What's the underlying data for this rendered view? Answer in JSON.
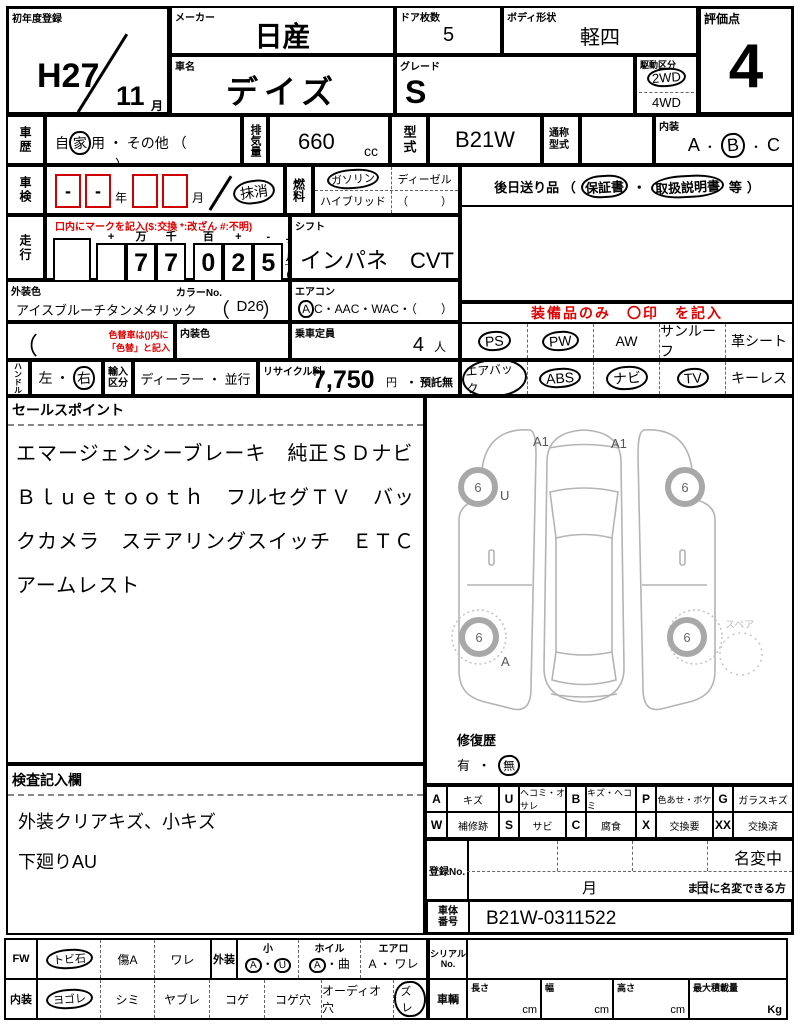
{
  "header": {
    "first_reg_label": "初年度登録",
    "first_reg_year": "H27",
    "first_reg_month": "11",
    "month_unit": "月",
    "maker_label": "メーカー",
    "maker": "日産",
    "car_name_label": "車名",
    "car_name": "デイズ",
    "doors_label": "ドア枚数",
    "doors": "5",
    "body_label": "ボディ形状",
    "body": "軽四",
    "grade_label": "グレード",
    "grade": "S",
    "drive_label": "駆動区分",
    "drive_2wd": "2WD",
    "drive_4wd": "4WD",
    "score_label": "評価点",
    "score": "4"
  },
  "history": {
    "label": "車歴",
    "p1": "自",
    "c": "家",
    "p2": "用",
    "sep": "・",
    "p3": "その他 （",
    "p4": "）"
  },
  "displacement": {
    "label": "排気量",
    "value": "660",
    "unit": "cc"
  },
  "model": {
    "label": "型式",
    "value": "B21W"
  },
  "common_model": {
    "label": "通称型式"
  },
  "interior": {
    "label": "内装",
    "a": "A",
    "b": "B",
    "c": "C",
    "dot": "・"
  },
  "shaken": {
    "label": "車検",
    "d1": "-",
    "d2": "-",
    "year": "年",
    "month": "月",
    "cancel": "抹消"
  },
  "fuel": {
    "label": "燃料",
    "gasoline": "ガソリン",
    "diesel": "ディーゼル",
    "hybrid": "ハイブリッド",
    "paren": "（　　　）"
  },
  "okuri": {
    "pre": "後日送り品 （",
    "w1": "保証書",
    "dot": "・",
    "w2": "取扱説明書",
    "tou": "等",
    "close": "）"
  },
  "mileage": {
    "label": "走行",
    "note": "口内にマークを記入($:交換 *:改ざん #:不明)",
    "cols": [
      "+",
      "万",
      "千",
      "百",
      "+",
      "-"
    ],
    "d": [
      "",
      "7",
      "7",
      "0",
      "2",
      "5"
    ],
    "comma": ",",
    "mile": "マイル",
    "km": "Km"
  },
  "shift": {
    "label": "シフト",
    "value": "インパネ　CVT"
  },
  "ext_color": {
    "label": "外装色",
    "value": "アイスブルーチタンメタリック",
    "color_no_label": "カラーNo.",
    "open": "（",
    "no": "D26",
    "close": "）"
  },
  "aircon": {
    "label": "エアコン",
    "a": "A",
    "rest": "C・AAC・WAC・（　　）"
  },
  "irogae": {
    "paren": "（　　　　）",
    "note1": "色替車は()内に",
    "note2": "「色替」と記入"
  },
  "int_color": {
    "label": "内装色"
  },
  "capacity": {
    "label": "乗車定員",
    "value": "4",
    "unit": "人"
  },
  "equip": {
    "note": "装備品のみ　〇印　を記入",
    "row1": [
      "PS",
      "PW",
      "AW",
      "サンルーフ",
      "革シート"
    ],
    "row2": [
      "エアバック",
      "ABS",
      "ナビ",
      "TV",
      "キーレス"
    ]
  },
  "handle": {
    "label": "ハンドル",
    "left": "左",
    "dot": "・",
    "right": "右"
  },
  "import": {
    "label1": "輸入",
    "label2": "区分",
    "value": "ディーラー ・ 並行"
  },
  "recycle": {
    "label": "リサイクル料",
    "fee": "7,750",
    "yen": "円",
    "rest": "・ 預託無"
  },
  "sales": {
    "label": "セールスポイント",
    "text": "エマージェンシーブレーキ　純正ＳＤナビ　Ｂｌｕｅｔｏｏｔｈ　フルセグＴＶ　バックカメラ　ステアリングスイッチ　ＥＴＣ　アームレスト"
  },
  "inspection": {
    "label": "検査記入欄",
    "line1": "外装クリアキズ、小キズ",
    "line2": "下廻りAU"
  },
  "diagram": {
    "a1": "A1",
    "u": "U",
    "a": "A",
    "tire": "6",
    "spare": "スペア",
    "repair_label": "修復歴",
    "repair_yes": "有",
    "repair_dot": "・",
    "repair_no": "無"
  },
  "legend": {
    "r1": [
      {
        "k": "A",
        "v": "キズ"
      },
      {
        "k": "U",
        "v": "ヘコミ・オサレ"
      },
      {
        "k": "B",
        "v": "キズ・ヘコミ"
      },
      {
        "k": "P",
        "v": "色あせ・ボケ"
      },
      {
        "k": "G",
        "v": "ガラスキズ"
      }
    ],
    "r2": [
      {
        "k": "W",
        "v": "補修跡"
      },
      {
        "k": "S",
        "v": "サビ"
      },
      {
        "k": "C",
        "v": "腐食"
      },
      {
        "k": "X",
        "v": "交換要"
      },
      {
        "k": "XX",
        "v": "交換済"
      }
    ]
  },
  "registration": {
    "label": "登録No.",
    "namechange": "名変中",
    "month": "月",
    "day": "日",
    "note": "までに名変できる方"
  },
  "chassis": {
    "label1": "車体",
    "label2": "番号",
    "value": "B21W-0311522"
  },
  "bottom": {
    "fw": "FW",
    "tobiishi": "トビ石",
    "kizua": "傷A",
    "ware": "ワレ",
    "gaiso": "外装",
    "small_label": "小",
    "small_a": "A",
    "small_dot": "・",
    "small_u": "U",
    "wheel_label": "ホイル",
    "wheel_a": "A",
    "wheel_dot": "・",
    "wheel_b": "曲",
    "aero_label": "エアロ",
    "aero_a": "A",
    "aero_dot": "・",
    "aero_w": "ワレ",
    "naiso": "内装",
    "yogore": "ヨゴレ",
    "shimi": "シミ",
    "yabure": "ヤブレ",
    "koge": "コゲ",
    "kogeana": "コゲ穴",
    "audioana": "オーディオ穴",
    "zure": "ズレ",
    "serial_label1": "シリアル",
    "serial_label2": "No.",
    "vehicle_label": "車輌",
    "length_label": "長さ",
    "width_label": "幅",
    "height_label": "高さ",
    "load_label": "最大積載量",
    "cm": "cm",
    "kg": "Kg"
  }
}
